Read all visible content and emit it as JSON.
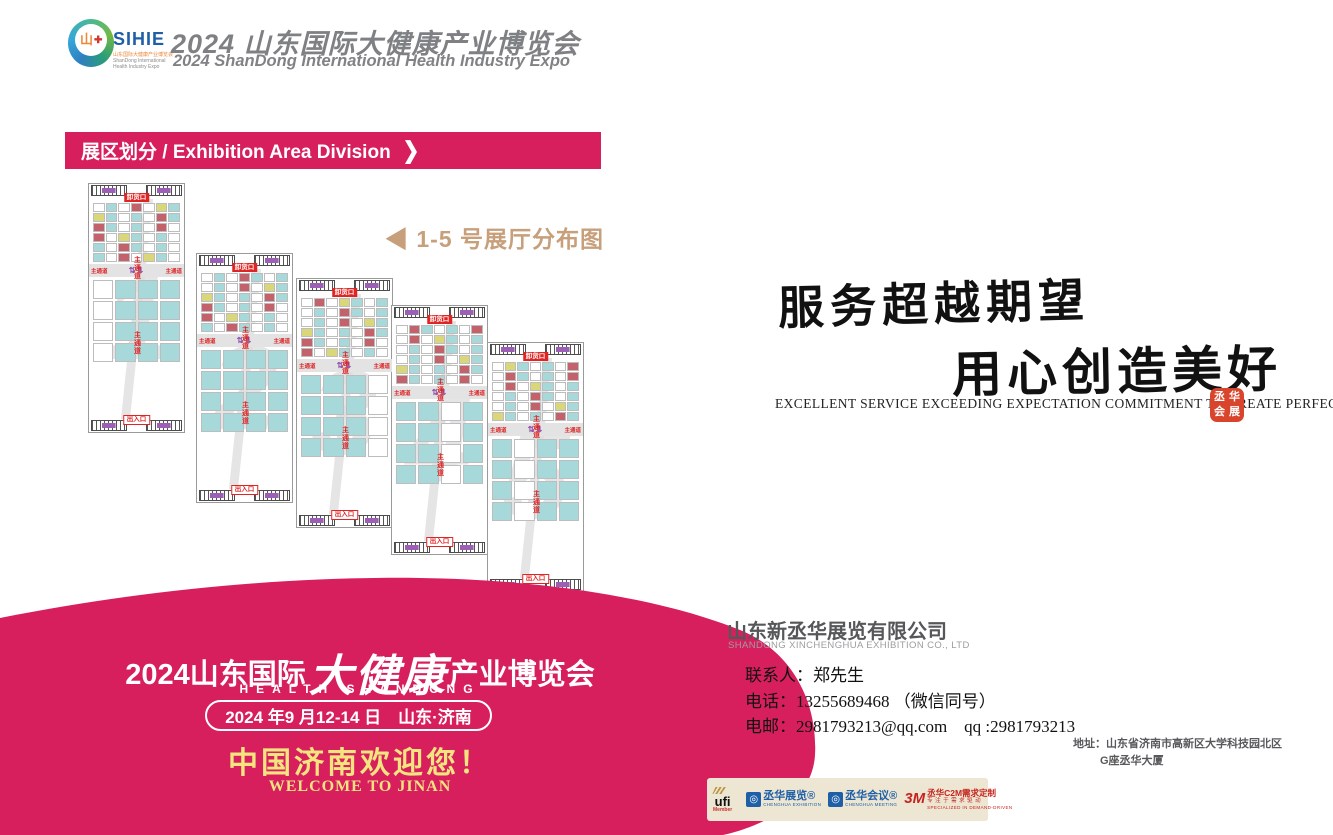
{
  "colors": {
    "accent": "#d81f5e",
    "gold_label": "#c79f7b",
    "yellow_text": "#f2e47f",
    "booth_teal": "#a7d8da",
    "booth_red": "#c4626c",
    "booth_yellow": "#d9d77a",
    "seal_red": "#d9452c"
  },
  "header": {
    "logo": {
      "sihie": "SIHIE",
      "sub1": "山东国际大健康产业博览会",
      "sub2": "ShanDong International",
      "sub3": "Health Industry Expo"
    },
    "title": "2024 山东国际大健康产业博览会",
    "subtitle": "2024 ShanDong International Health Industry Expo"
  },
  "section_banner": {
    "label": "展区划分 / Exhibition Area Division",
    "chevron": "❯"
  },
  "floorplan": {
    "caption": "◀ 1-5 号展厅分布图",
    "labels": {
      "unload": "卸货口",
      "entrance": "出入口",
      "aisle": "主通道",
      "arrows": "⇅⇅"
    },
    "halls": [
      {
        "number": "1"
      },
      {
        "number": "2"
      },
      {
        "number": "3"
      },
      {
        "number": "4"
      },
      {
        "number": "5"
      }
    ]
  },
  "slogan": {
    "line1": "服务超越期望",
    "line2": "用心创造美好",
    "english": "EXCELLENT SERVICE EXCEEDING EXPECTATION COMMITMENT TO CREATE PERFECTION",
    "seal_chars": [
      "丞",
      "华",
      "会",
      "展"
    ]
  },
  "promo": {
    "title_prefix": "2024山东国际",
    "title_script": "大健康",
    "title_suffix": "产业博览会",
    "subtitle": "HEALTH SHANDONG",
    "date_pill": "2024 年9 月12-14 日　山东·济南",
    "welcome_cn": "中国济南欢迎您！",
    "welcome_en": "WELCOME TO JINAN"
  },
  "company": {
    "name": "山东新丞华展览有限公司",
    "name_en": "SHANDONG XINCHENGHUA EXHIBITION CO., LTD",
    "contact": "联系人：郑先生",
    "phone": "电话：13255689468 （微信同号）",
    "email": "电邮：2981793213@qq.com　qq :2981793213",
    "address1": "地址：山东省济南市高新区大学科技园北区",
    "address2": "G座丞华大厦"
  },
  "partners": {
    "ufi": {
      "name": "ufi",
      "member": "Member"
    },
    "exhibition": {
      "name": "丞华展览®",
      "sub": "CHENGHUA EXHIBITION"
    },
    "meeting": {
      "name": "丞华会议®",
      "sub": "CHENGHUA MEETING"
    },
    "c2m": {
      "logo": "3M",
      "name": "丞华C2M需求定制",
      "sub1": "专注于需求驱动",
      "sub2": "SPECIALIZED IN DEMAND-DRIVEN"
    }
  }
}
